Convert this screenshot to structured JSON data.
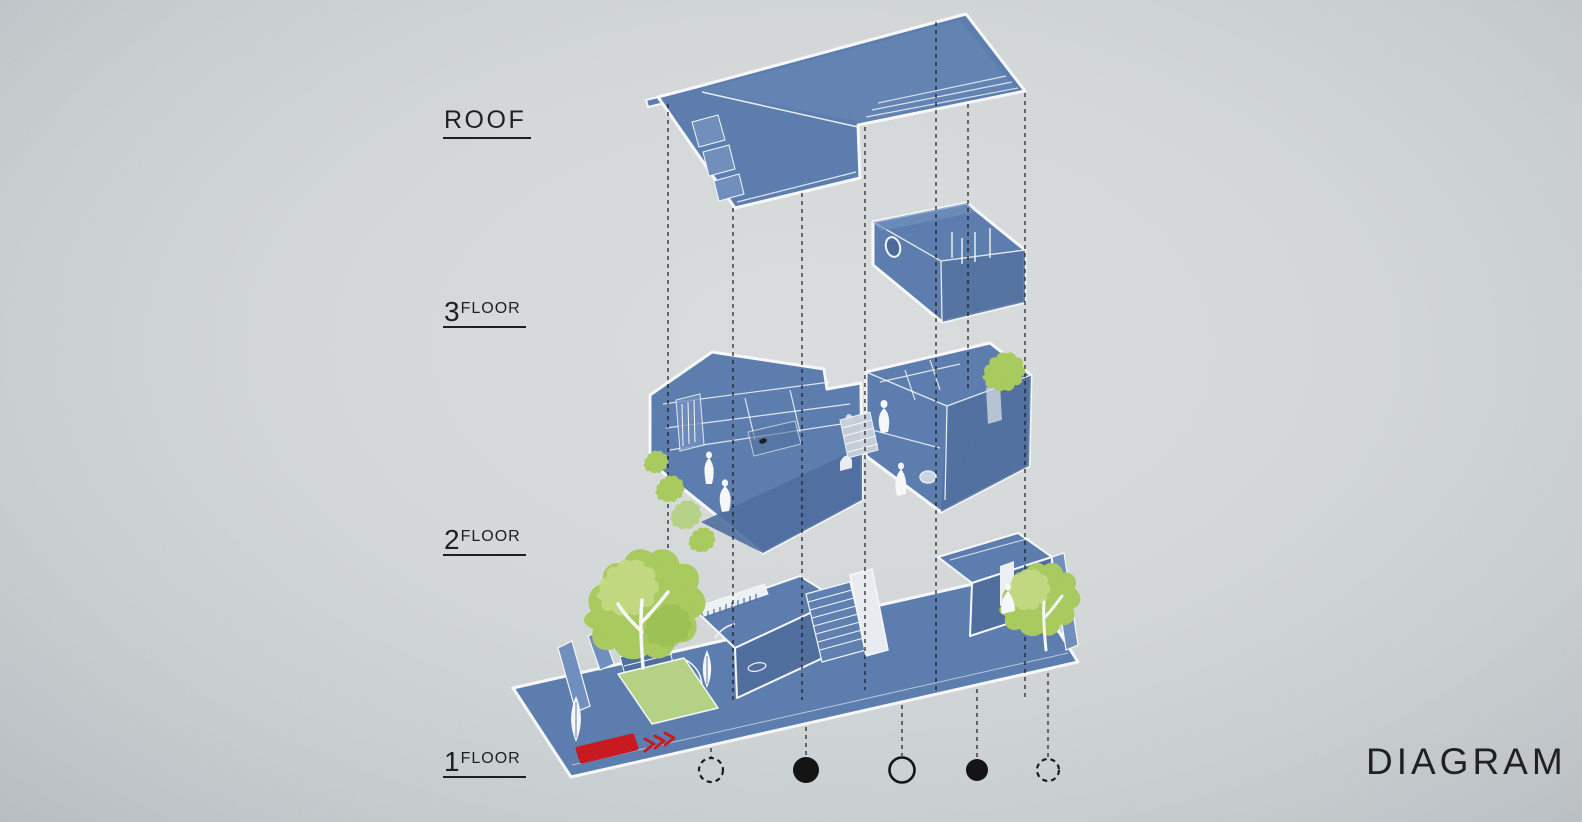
{
  "title": {
    "label": "DIAGRAM"
  },
  "floors": [
    {
      "number": "",
      "name": "ROOF"
    },
    {
      "number": "3",
      "name": "FLOOR"
    },
    {
      "number": "2",
      "name": "FLOOR"
    },
    {
      "number": "1",
      "name": "FLOOR"
    }
  ],
  "legend_markers": [
    {
      "style": "dashed-outline"
    },
    {
      "style": "filled"
    },
    {
      "style": "outline"
    },
    {
      "style": "filled"
    },
    {
      "style": "dashed-outline"
    }
  ],
  "palette": {
    "background": "#d3d7d8",
    "plan_blue": "#5a7cae",
    "plan_blue_dark": "#4d6d9e",
    "plan_blue_light": "#6f8ebc",
    "outline_white": "#f7f9fa",
    "foliage_green": "#a8ca5c",
    "foliage_green_light": "#c3da83",
    "lawn_green": "#b5d285",
    "entry_arrow_red": "#c8171d",
    "line_black": "#161616"
  },
  "diagram": {
    "type": "exploded-axonometric",
    "levels": [
      "roof",
      "third-floor",
      "second-floor",
      "first-floor"
    ],
    "features": [
      "entry-arrow",
      "trees",
      "human-figures",
      "projection-lines",
      "column-markers"
    ]
  }
}
